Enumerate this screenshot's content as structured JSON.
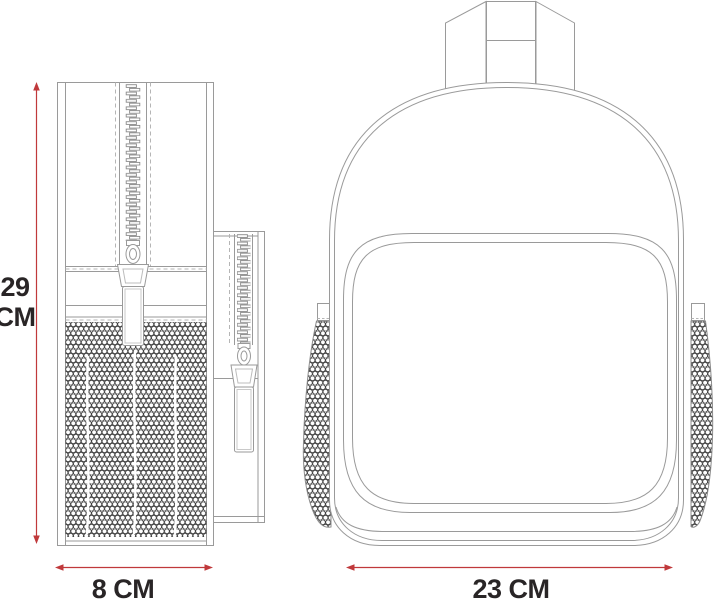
{
  "title": "Backpack dimension diagram",
  "colors": {
    "outline": "#9a9a9a",
    "stitch": "#b5b5b5",
    "mesh": "#3c3c3c",
    "dimension_red": "#c0393b",
    "label_text": "#292526",
    "background": "#ffffff"
  },
  "labels": {
    "height": {
      "line1": "29",
      "line2": "CM"
    },
    "side_width": "8 CM",
    "front_width": "23 CM"
  }
}
